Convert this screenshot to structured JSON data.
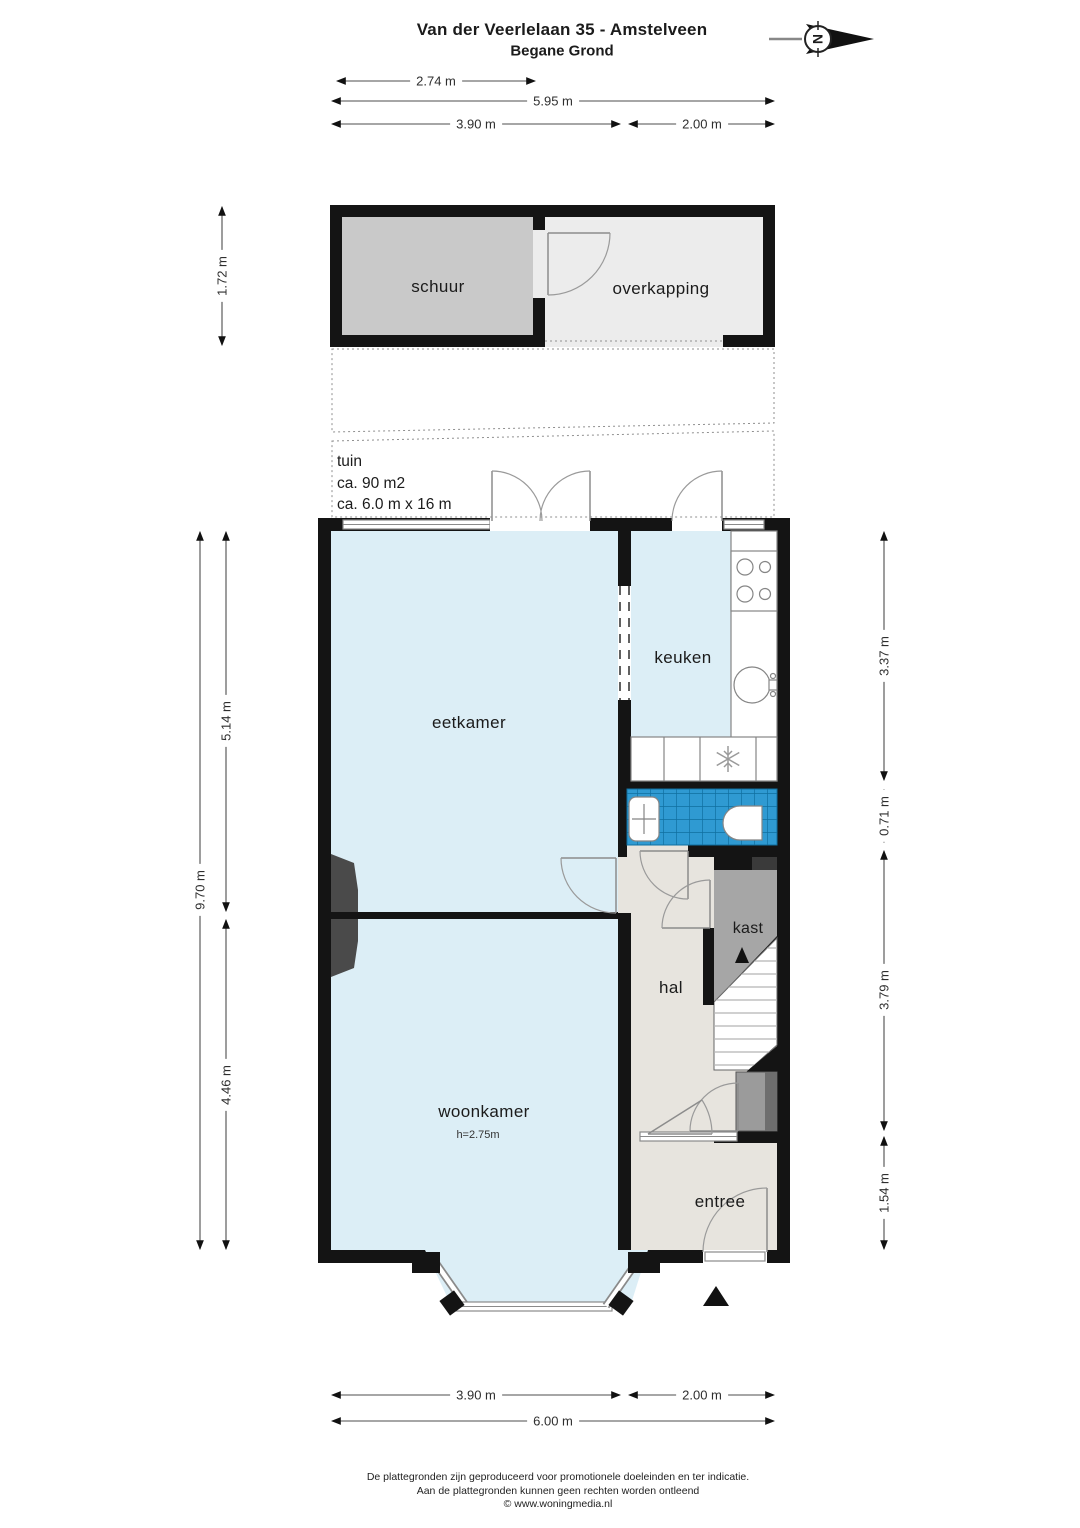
{
  "header": {
    "title": "Van der Veerlelaan 35 - Amstelveen",
    "subtitle": "Begane Grond"
  },
  "compass": {
    "letter": "N"
  },
  "rooms": {
    "schuur": {
      "label": "schuur"
    },
    "overkapping": {
      "label": "overkapping"
    },
    "tuin": {
      "label": "tuin",
      "area": "ca. 90 m2",
      "size": "ca. 6.0 m x 16 m"
    },
    "eetkamer": {
      "label": "eetkamer"
    },
    "keuken": {
      "label": "keuken"
    },
    "kast": {
      "label": "kast"
    },
    "hal": {
      "label": "hal"
    },
    "woonkamer": {
      "label": "woonkamer",
      "ceiling_height": "h=2.75m"
    },
    "entree": {
      "label": "entree"
    }
  },
  "dims": {
    "top_schuur": "2.74 m",
    "top_total": "5.95 m",
    "top_left": "3.90 m",
    "top_right": "2.00 m",
    "left_schuur": "1.72 m",
    "left_total": "9.70 m",
    "left_eetkamer": "5.14 m",
    "left_woonkamer": "4.46 m",
    "right_keuken": "3.37 m",
    "right_toilet": "0.71 m",
    "right_hal": "3.79 m",
    "right_entree": "1.54 m",
    "bottom_left": "3.90 m",
    "bottom_right": "2.00 m",
    "bottom_total": "6.00 m"
  },
  "footer": {
    "line1": "De plattegronden zijn geproduceerd voor promotionele doeleinden en ter indicatie.",
    "line2": "Aan de plattegronden kunnen geen rechten worden ontleend",
    "line3": "© www.woningmedia.nl"
  },
  "colors": {
    "wall": "#141414",
    "room_blue": "#dceef6",
    "floor_warm": "#e7e4de",
    "tile_blue": "#2f9ad2",
    "tile_line": "#0f6fa0",
    "schuur_fill": "#c9c9c9",
    "light_gray": "#ececec",
    "kast_gray": "#a6a6a6",
    "chimney": "#4a4a4a"
  }
}
